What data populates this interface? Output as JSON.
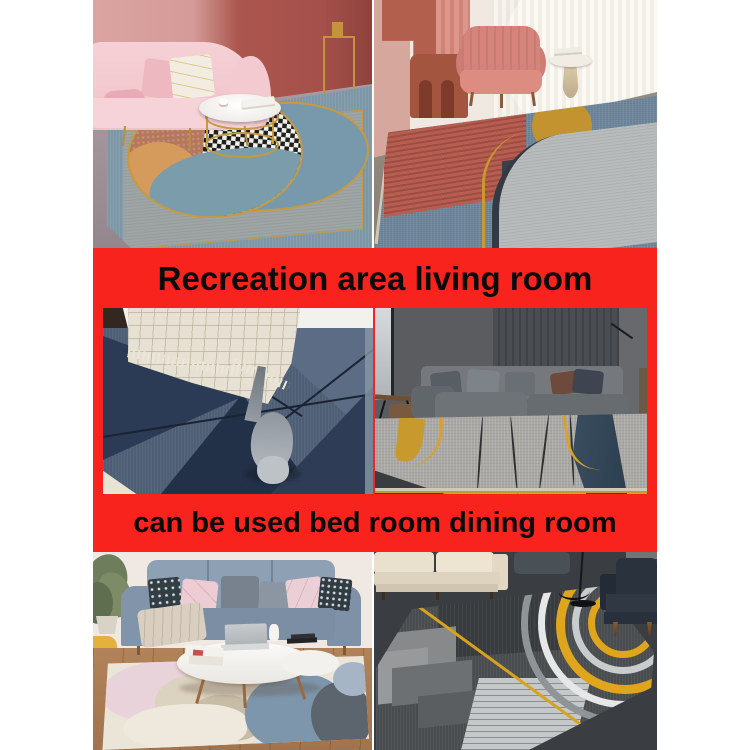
{
  "image_type": "e-commerce rug product photo collage",
  "colors": {
    "banner_red": "#f7231c",
    "banner_text": "#0b0b0b",
    "page_background": "#ffffff"
  },
  "banners": [
    {
      "text": "Recreation area living room"
    },
    {
      "text": "can be used bed room dining room"
    }
  ],
  "photos": [
    {
      "name": "pink-sofa-living-room",
      "alt": "Pink velvet sofa and gold round coffee table on a blue, rust and checkered oval-motif rug"
    },
    {
      "name": "salmon-armchair-room",
      "alt": "Salmon armchair by sheer curtains on a rug with red stripes, gold circle and grey rounded block"
    },
    {
      "name": "cat-on-geometric-rug",
      "alt": "Grey cat walking on a navy geometric triangle rug beside a tasseled checkered tablecloth"
    },
    {
      "name": "grey-sofa-dark-room",
      "alt": "Grey modular sofa against a dark slat wall on a grey rug with teal band and gold curves"
    },
    {
      "name": "blue-sofa-pastel-rug",
      "alt": "Blue-grey sofa with pink cushions and oval coffee table on a pastel abstract blob rug"
    },
    {
      "name": "dark-lounge-arc-rug",
      "alt": "Dark lounge with cream sofa, navy armchair and charcoal rug with yellow and grey concentric arcs"
    }
  ]
}
